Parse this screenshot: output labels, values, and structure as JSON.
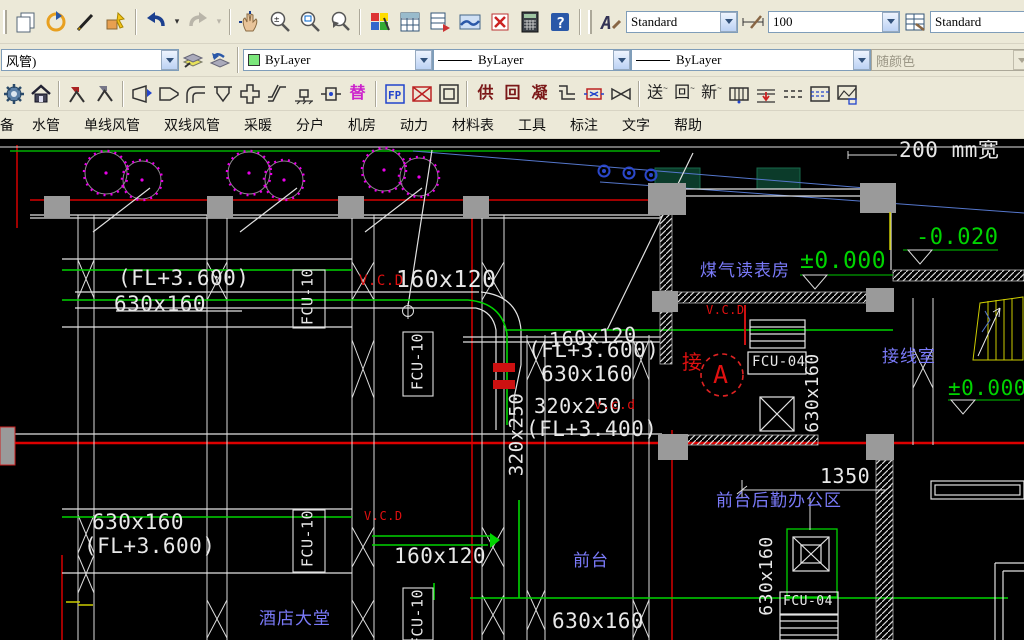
{
  "toolbar_top": {
    "text_style_value": "Standard",
    "dim_scale_value": "100",
    "table_style_value": "Standard"
  },
  "properties_bar": {
    "layer_value": "风管)",
    "color_value": "ByLayer",
    "linetype_value": "ByLayer",
    "lineweight_value": "ByLayer",
    "plot_style_value": "随颜色"
  },
  "hvac_toolbar": {
    "supply_pipe": "供",
    "return_pipe": "回",
    "condensate_pipe": "凝",
    "supply_air": "送",
    "return_air": "回",
    "fresh_air": "新",
    "replace": "替",
    "fp": "FP",
    "tilde": "~"
  },
  "menu": {
    "items": [
      "备",
      "水管",
      "单线风管",
      "双线风管",
      "采暖",
      "分户",
      "机房",
      "动力",
      "材料表",
      "工具",
      "标注",
      "文字",
      "帮助"
    ]
  },
  "drawing": {
    "labels": {
      "width_note": "200 mm宽",
      "lvl_zero_a": "±0.000",
      "lvl_neg": "-0.020",
      "lvl_zero_b": "±0.000",
      "room_gas": "煤气读表房",
      "room_junction": "接线室",
      "room_back": "前台后勤办公区",
      "room_front": "前台",
      "room_lobby": "酒店大堂",
      "fl3600_a": "(FL+3.600)",
      "duct630_a": "630x160",
      "vcd_a": "V.C.D",
      "duct160_a": "160x120",
      "duct160_b": "160x120",
      "fl3600_b": "(FL+3.600)",
      "duct630_b": "630x160",
      "duct320": "320x250",
      "vcd_b": "v.c.d",
      "fl3400": "(FL+3.400)",
      "v320": "320x250",
      "fcu10_a": "FCU-10",
      "fcu10_b": "FCU-10",
      "fcu10_c": "FCU-10",
      "fcu10_d": "FCU-10",
      "fcu04_a": "FCU-04",
      "fcu04_b": "FCU-04",
      "v630_a": "630x160",
      "v630_b": "630x160",
      "jie": "接",
      "circle_a": "A",
      "vcd_small_a": "V.C.D",
      "vcd_c": "V.C.D",
      "dim_1350": "1350",
      "duct630_c": "630x160",
      "fl3600_c": "(FL+3.600)",
      "duct160_c": "160x120",
      "duct630_d": "630x160"
    }
  },
  "colors": {
    "toolbar_bg": "#ece9d8",
    "canvas_bg": "#000000",
    "duct_green": "#00d400",
    "annotation_white": "#e8e8e8",
    "room_label_blue": "#7a7af8",
    "alert_red": "#e01010",
    "grid_dark_red": "#a00000",
    "tree_magenta": "#e800e8",
    "column_gray": "#9a9a9a",
    "stair_yellow": "#cccc00",
    "bylayer_swatch_green": "#7CE77C"
  }
}
